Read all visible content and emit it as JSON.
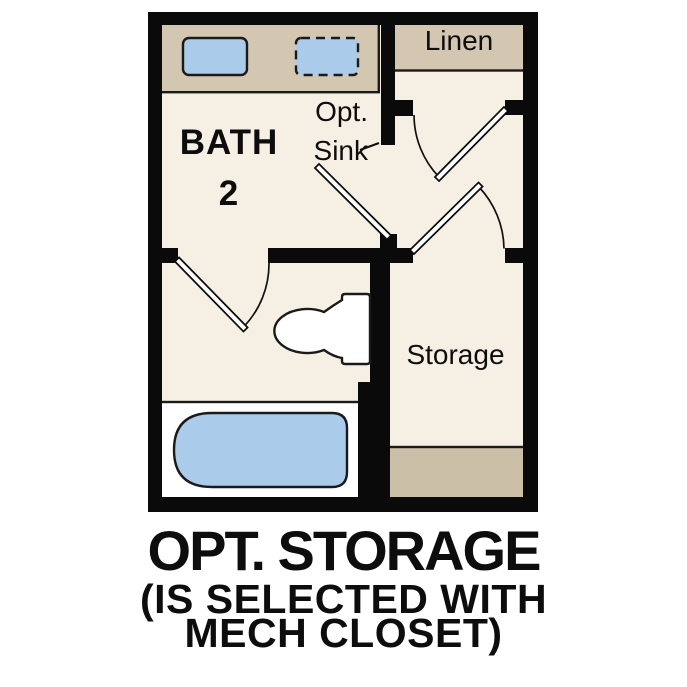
{
  "floor_plan": {
    "labels": {
      "bath": {
        "line1": "BATH",
        "line2": "2"
      },
      "opt_sink": {
        "line1": "Opt.",
        "line2": "Sink"
      },
      "linen": "Linen",
      "storage": "Storage"
    },
    "caption": {
      "line1": "OPT. STORAGE",
      "line2": "(IS SELECTED WITH",
      "line3": "MECH CLOSET)"
    },
    "colors": {
      "wall_black": "#0a0a0a",
      "floor_cream": "#f6f0e4",
      "counter_tan": "#d4c7b2",
      "storage_strip_tan": "#cbc0a7",
      "fixture_blue": "#abcbea",
      "fixture_white": "#ffffff"
    },
    "fixtures": {
      "sink": "sink",
      "optional_sink": "optional sink (dashed)",
      "toilet": "toilet",
      "bathtub": "bathtub"
    }
  }
}
